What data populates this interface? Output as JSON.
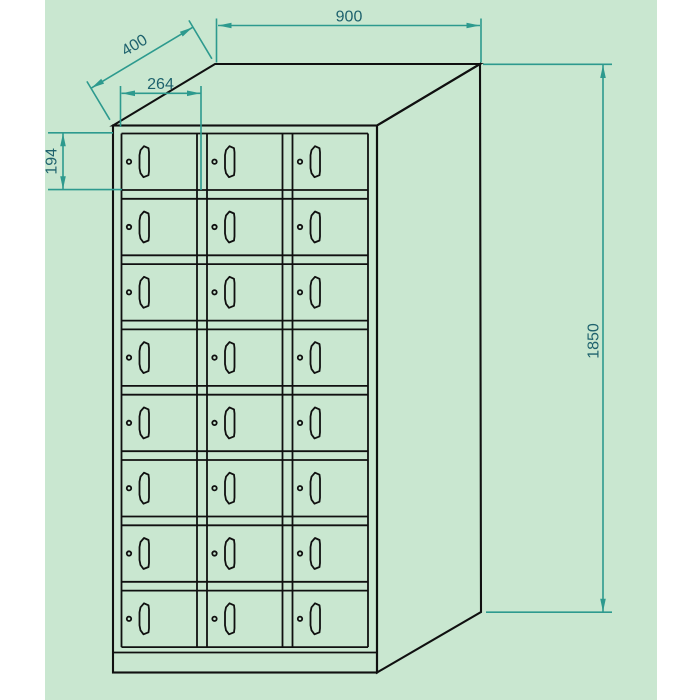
{
  "drawing": {
    "title": "metal locker cabinet technical drawing",
    "dimensions": {
      "overall_width": "900",
      "overall_depth": "400",
      "overall_height": "1850",
      "compartment_width": "264",
      "compartment_height": "194"
    },
    "grid": {
      "rows": 8,
      "columns": 3,
      "compartments": 24
    },
    "door_features": [
      "lock",
      "handle"
    ]
  },
  "colors": {
    "bg-green": "#c9e7d0",
    "line-black": "#101010",
    "dim-line": "#2d9a8e",
    "dim-text": "#1e626d"
  }
}
